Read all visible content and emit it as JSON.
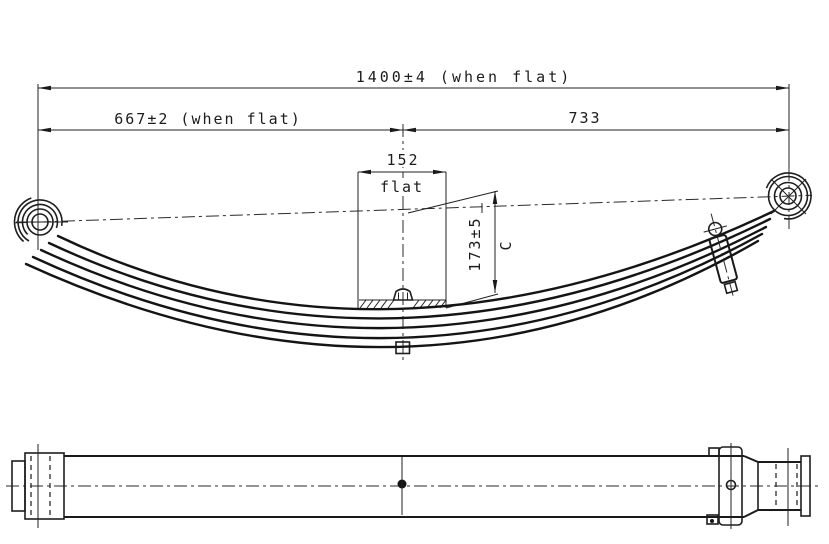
{
  "drawing": {
    "background": "#ffffff",
    "ink": "#1c1c1c",
    "views": {
      "side_view": "side-elevation",
      "plan_view": "top-plan"
    },
    "dimensions": {
      "overall": "1400±4 (when flat)",
      "left_segment": "667±2 (when flat)",
      "right_segment": "733",
      "seat_length": "152",
      "seat_note": "flat",
      "free_camber": "173±5",
      "camber_label": "C"
    }
  }
}
